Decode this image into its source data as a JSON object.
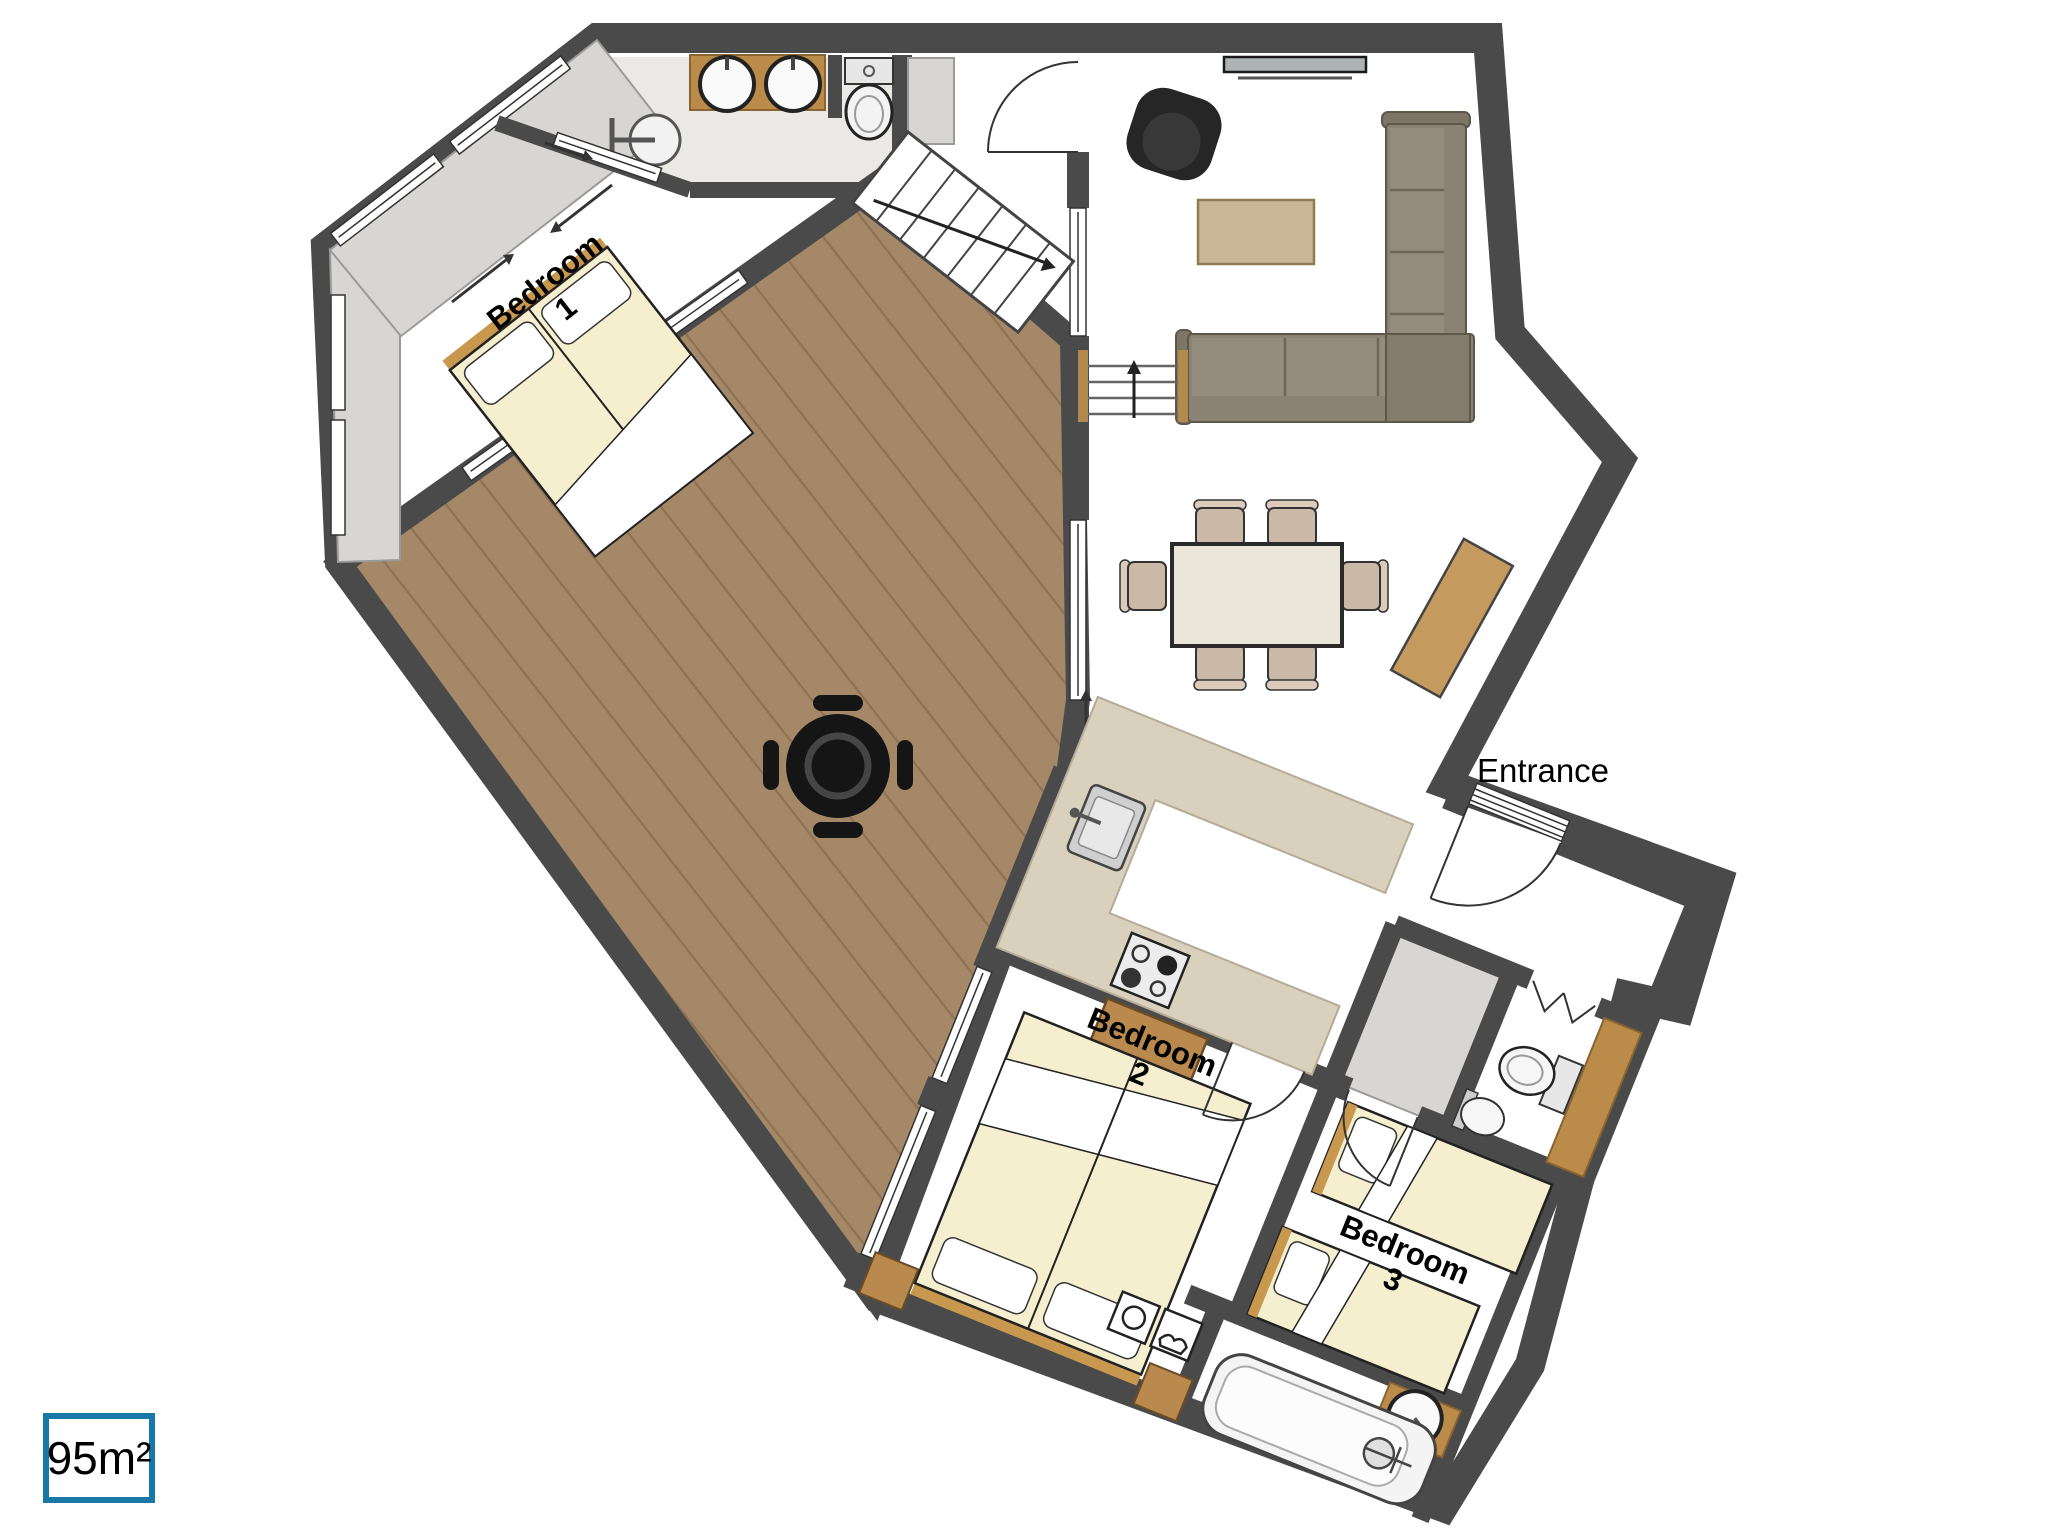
{
  "title": "Apartment floor plan",
  "area_label": "95m²",
  "rooms": {
    "bedroom1": {
      "label": "Bedroom",
      "number": "1"
    },
    "bedroom2": {
      "label": "Bedroom",
      "number": "2"
    },
    "bedroom3": {
      "label": "Bedroom",
      "number": "3"
    },
    "entrance": {
      "label": "Entrance"
    }
  },
  "colors": {
    "wall": "#4a4a4a",
    "terrace_deck": "#a58868",
    "plank_line": "#8d7254",
    "closet": "#d8d6d3",
    "bath_floor": "#ebe9e5",
    "counter_wood": "#bb8c49",
    "kitchen_counter": "#d9d0bd",
    "bed": "#f5efcf",
    "bed_trim": "#c8984f",
    "sofa": "#8a8273",
    "coffee_table": "#c9b795",
    "dining_chair": "#cbb9a7",
    "armchair": "#262626",
    "accent_border": "#1878a8"
  },
  "icons": [
    "shower-icon",
    "bath-sink-icon",
    "toilet-icon",
    "stairs-up-icon",
    "stair-railing-icon",
    "tv-icon",
    "armchair-icon",
    "sofa-icon",
    "coffee-table-icon",
    "dining-table-icon",
    "dining-chair-icon",
    "sideboard-icon",
    "terrace-table-icon",
    "kitchen-sink-icon",
    "stove-icon",
    "desk-icon",
    "washer-icon",
    "dryer-icon",
    "bathtub-icon",
    "round-sink-icon",
    "wc-toilet-icon",
    "wc-sink-icon",
    "door-arc-icon",
    "window-icon",
    "sliding-door-arrow-icon"
  ]
}
